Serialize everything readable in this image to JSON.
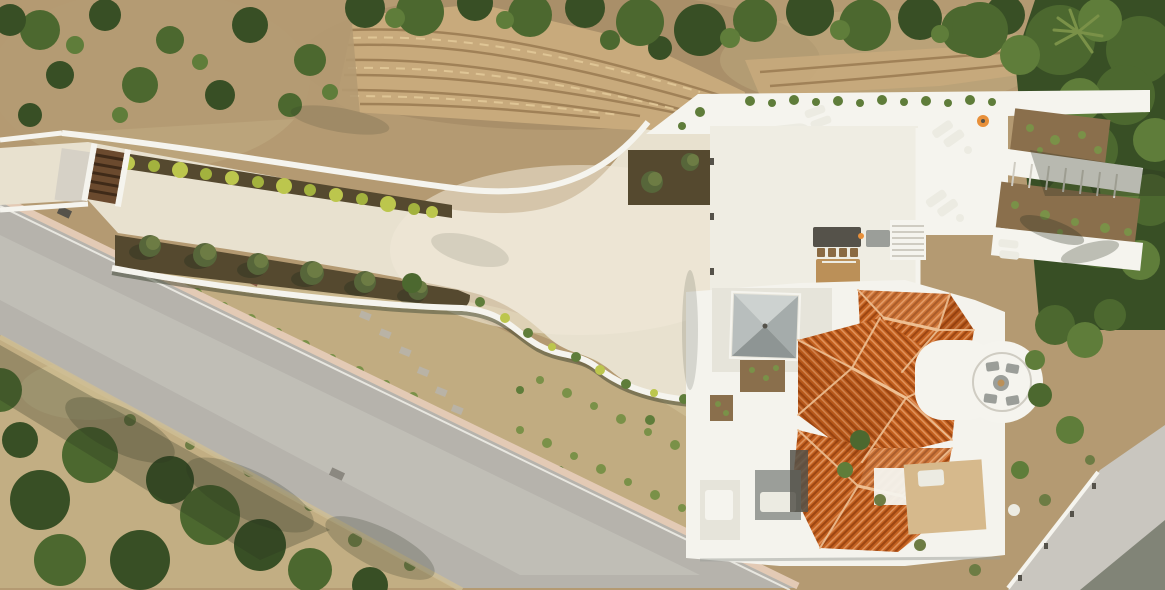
{
  "scene": {
    "type": "aerial-drone-photograph",
    "description": "Top-down drone view of a modern Mediterranean villa estate on a hillside: freeform turquoise swimming pool on a white sun deck, huge cream concrete driveway apron behind an entrance gate, diagonal grey asphalt road, stone terraced retaining wall with trees above, terracotta hipped roofs with a grey pyramid pavilion, circular fire-pit terrace, landscaped olive trees, hedges and scrubland",
    "features": [
      "freeform-swimming-pool",
      "sun-loungers",
      "pool-deck",
      "olive-trees",
      "entrance-gate",
      "driveway-apron",
      "asphalt-road",
      "stone-retaining-wall",
      "terracotta-roof-villa",
      "grey-pyramid-pavilion",
      "circular-fire-pit-terrace",
      "outdoor-dining-table",
      "outdoor-kitchen",
      "garden-beds",
      "hillside-shrubs",
      "dense-trees",
      "palm-tree"
    ]
  },
  "palette": {
    "dirt": "#b49a72",
    "dirt_dark": "#9d8460",
    "dry": "#c2ae83",
    "dry_light": "#cfbf95",
    "green_dark": "#384f25",
    "green_mid": "#4c682f",
    "green_light": "#5f7d3a",
    "green_pale": "#7a9148",
    "olive": "#6d7c44",
    "olive_dark": "#57663a",
    "hedge_yellow": "#bcc64d",
    "hedge_yellow2": "#a3b23e",
    "soil": "#55492f",
    "soil_light": "#8a6f4c",
    "stone": "#c8aa7c",
    "stone_line": "#97784f",
    "stone_light": "#e2c998",
    "road": "#b6b3ac",
    "road_light": "#c9c6bf",
    "curb": "#e3cab5",
    "driveway": "#e8e1cf",
    "driveway_light": "#f0e9d8",
    "white": "#f5f4ee",
    "white_dim": "#ecebe2",
    "court": "#efede3",
    "flat_roof": "#e6e4da",
    "villa": "#f4f3ed",
    "terrace_tan": "#d6b98c",
    "pool_deep": "#35aebe",
    "pool_mid": "#2b9aab",
    "pool_shallow": "#93cfce",
    "pool_arc": "#c3e6e2",
    "trough": "#4c4a33",
    "tile": "#c4611f",
    "tile_dark": "#9c4613",
    "tile_light": "#e0915a",
    "ridge": "#eebf92",
    "pyr_n": "#cdd2d0",
    "pyr_w": "#b8bebd",
    "pyr_e": "#a5acab",
    "pyr_s": "#8e9594",
    "gray_f": "#9b9e99",
    "gray_d": "#55524a",
    "wood": "#6b4a2e",
    "wood_dark": "#3f2a18",
    "table": "#bb9058",
    "chair": "#8a6a42",
    "umbrella": "#e8903a",
    "shadow": "#2a3220",
    "steps_line": "#cfccc2",
    "paver": "#b9b3a6"
  }
}
